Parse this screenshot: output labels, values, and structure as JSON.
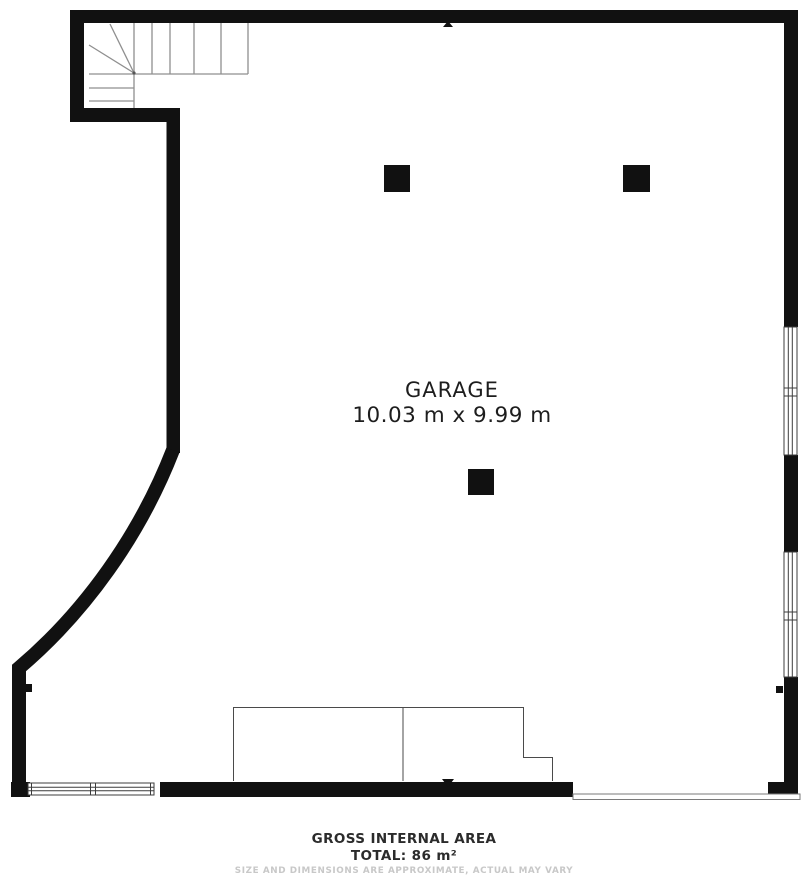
{
  "plan": {
    "room_label": "GARAGE",
    "room_dimensions": "10.03 m x 9.99 m"
  },
  "footer": {
    "line1": "GROSS INTERNAL AREA",
    "line2": "TOTAL: 86 m²",
    "disclaimer": "SIZE AND DIMENSIONS ARE APPROXIMATE, ACTUAL MAY VARY"
  },
  "colors": {
    "wall": "#111111",
    "stair_line": "#8f8f8f",
    "thin_line": "#4a4a4a",
    "window_line": "#3c3c3c",
    "label_text": "#1d1d1d",
    "disclaimer_text": "#c8c8c8",
    "background": "#ffffff"
  }
}
